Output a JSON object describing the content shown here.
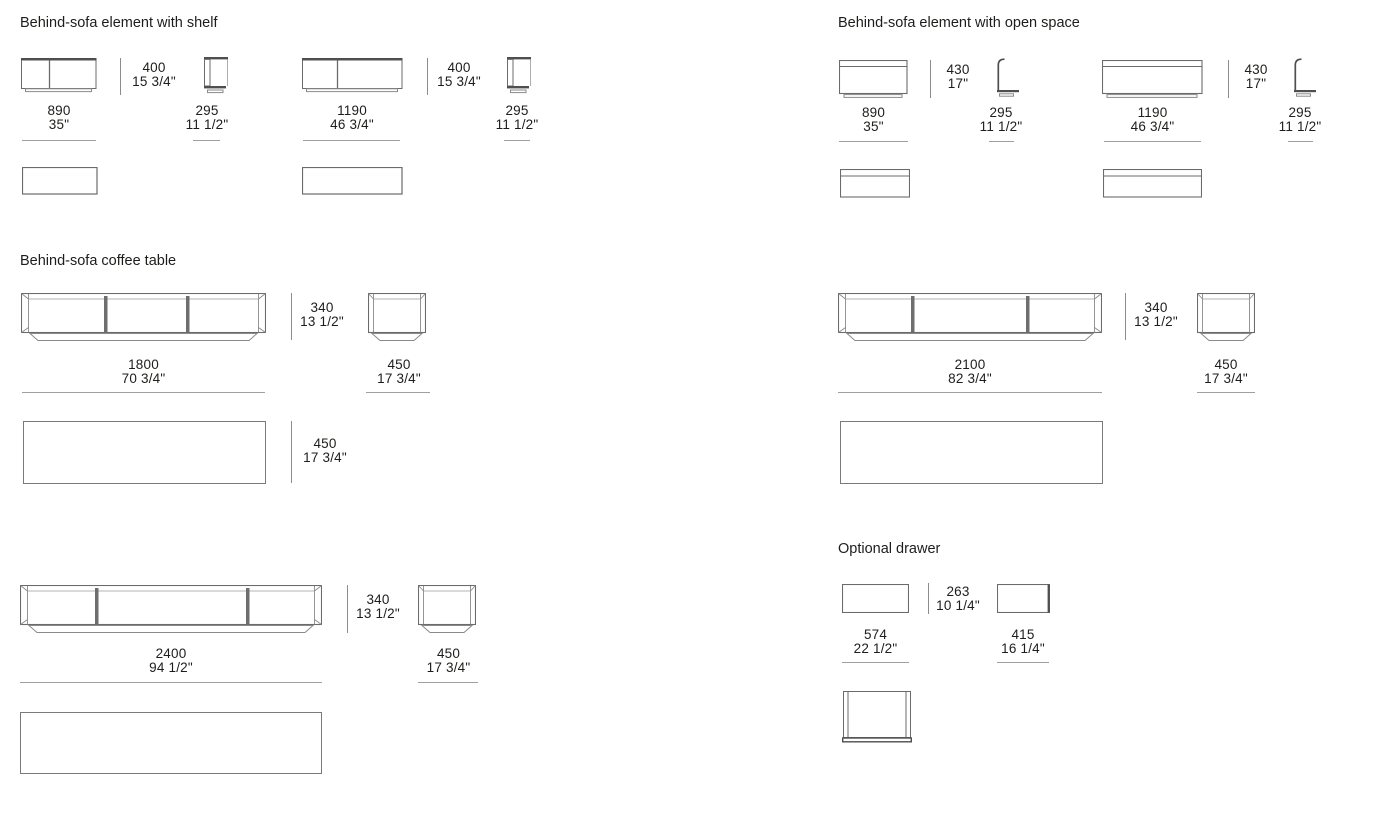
{
  "sections": {
    "shelf": {
      "title": "Behind-sofa element with shelf",
      "items": {
        "w890": {
          "w1": "890",
          "w2": "35\"",
          "h1": "400",
          "h2": "15 3/4\"",
          "d1": "295",
          "d2": "11 1/2\""
        },
        "w1190": {
          "w1": "1190",
          "w2": "46 3/4\"",
          "h1": "400",
          "h2": "15 3/4\"",
          "d1": "295",
          "d2": "11 1/2\""
        }
      }
    },
    "open_space": {
      "title": "Behind-sofa element with open space",
      "items": {
        "w890": {
          "w1": "890",
          "w2": "35\"",
          "h1": "430",
          "h2": "17\"",
          "d1": "295",
          "d2": "11 1/2\""
        },
        "w1190": {
          "w1": "1190",
          "w2": "46 3/4\"",
          "h1": "430",
          "h2": "17\"",
          "d1": "295",
          "d2": "11 1/2\""
        }
      }
    },
    "coffee_table": {
      "title": "Behind-sofa coffee table",
      "items": {
        "w1800": {
          "w1": "1800",
          "w2": "70 3/4\"",
          "h1": "340",
          "h2": "13 1/2\"",
          "d1": "450",
          "d2": "17 3/4\"",
          "t1": "450",
          "t2": "17 3/4\""
        },
        "w2100": {
          "w1": "2100",
          "w2": "82 3/4\"",
          "h1": "340",
          "h2": "13 1/2\"",
          "d1": "450",
          "d2": "17 3/4\""
        },
        "w2400": {
          "w1": "2400",
          "w2": "94 1/2\"",
          "h1": "340",
          "h2": "13 1/2\"",
          "d1": "450",
          "d2": "17 3/4\""
        }
      }
    },
    "drawer": {
      "title": "Optional drawer",
      "items": {
        "d574": {
          "w1": "574",
          "w2": "22 1/2\"",
          "h1": "263",
          "h2": "10 1/4\"",
          "d1": "415",
          "d2": "16 1/4\""
        }
      }
    }
  }
}
